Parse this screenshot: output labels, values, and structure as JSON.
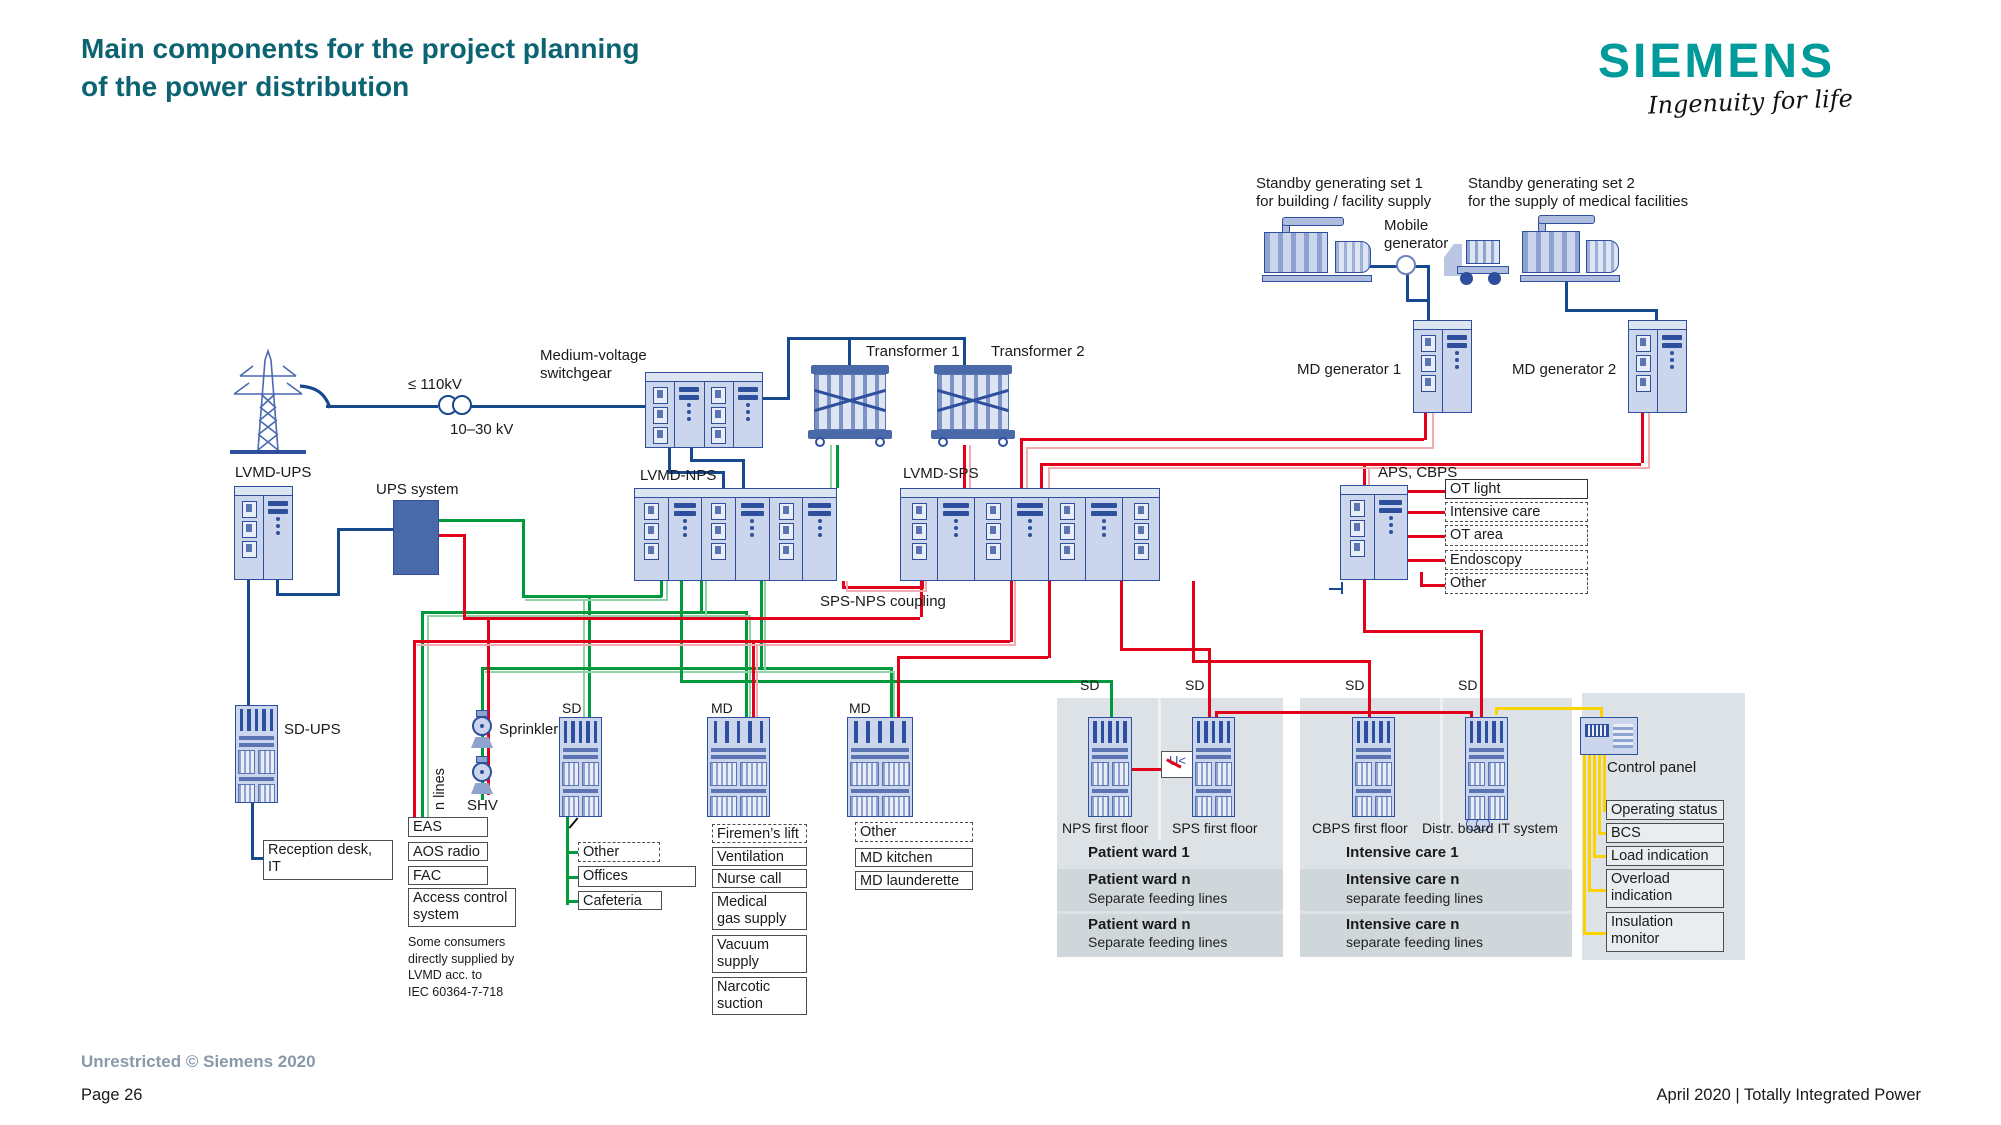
{
  "header": {
    "title": "Main components for the project planning\nof the power distribution",
    "brand": "SIEMENS",
    "tagline": "Ingenuity for life"
  },
  "footer": {
    "classification": "Unrestricted © Siemens 2020",
    "page": "Page 26",
    "edition": "April 2020 | Totally Integrated Power"
  },
  "colors": {
    "accent_teal": "#0c6472",
    "brand_teal": "#009a9a",
    "wire_blue": "#17498f",
    "wire_green": "#009a3d",
    "wire_red": "#e2001a",
    "wire_yellow": "#fcd200",
    "cabinet_fill": "#cbd5eb",
    "cabinet_border": "#2e4f9e",
    "panel_gray": "#dce2e6"
  },
  "grid": {
    "hv": "≤ 110kV",
    "mv": "10–30 kV",
    "switchgear": "Medium-voltage\nswitchgear",
    "transformer1": "Transformer 1",
    "transformer2": "Transformer 2"
  },
  "generators": {
    "standby1": "Standby generating set 1\nfor building / facility supply",
    "standby2": "Standby generating set 2\nfor the supply of medical facilities",
    "mobile": "Mobile\ngenerator",
    "md1": "MD generator 1",
    "md2": "MD generator 2"
  },
  "mains": {
    "lvmd_ups": "LVMD-UPS",
    "ups": "UPS system",
    "lvmd_nps": "LVMD-NPS",
    "lvmd_sps": "LVMD-SPS",
    "coupling": "SPS-NPS coupling",
    "aps": "APS, CBPS"
  },
  "aps_outputs": [
    {
      "label": "OT light"
    },
    {
      "label": "Intensive care rooms"
    },
    {
      "label": "OT area"
    },
    {
      "label": "Endoscopy"
    },
    {
      "label": "Other"
    }
  ],
  "left_branch": {
    "sd_ups": "SD-UPS",
    "reception": "Reception desk,\nIT",
    "n_lines": "n lines",
    "sprinkler": "Sprinkler",
    "shv": "SHV",
    "boxes": [
      {
        "label": "EAS"
      },
      {
        "label": "AOS radio"
      },
      {
        "label": "FAC"
      },
      {
        "label": "Access control\nsystem"
      }
    ],
    "note": "Some consumers\ndirectly supplied by\nLVMD acc. to\nIEC 60364-7-718"
  },
  "sub_boards": {
    "sd": "SD",
    "md1": "MD",
    "md2": "MD",
    "sd_outputs": [
      {
        "label": "Other"
      },
      {
        "label": "Offices"
      },
      {
        "label": "Cafeteria"
      }
    ],
    "md1_outputs": [
      {
        "label": "Firemen’s lift"
      },
      {
        "label": "Ventilation sys."
      },
      {
        "label": "Nurse call"
      },
      {
        "label": "Medical\ngas supply"
      },
      {
        "label": "Vacuum\nsupply"
      },
      {
        "label": "Narcotic\nsuction"
      }
    ],
    "md2_outputs": [
      {
        "label": "Other"
      },
      {
        "label": "MD kitchen"
      },
      {
        "label": "MD launderette"
      }
    ]
  },
  "floor_sd": [
    "SD",
    "SD",
    "SD",
    "SD"
  ],
  "ward_panel": {
    "board1": "NPS first floor",
    "board2": "SPS first floor",
    "relay": "U<",
    "rows": [
      {
        "title": "Patient ward 1",
        "sub": ""
      },
      {
        "title": "Patient ward n",
        "sub": "Separate feeding lines"
      },
      {
        "title": "Patient ward n",
        "sub": "Separate feeding lines"
      }
    ]
  },
  "icu_panel": {
    "board1": "CBPS first floor",
    "board2": "Distr. board IT system",
    "relay": "U<",
    "z": "Z",
    "rows": [
      {
        "title": "Intensive care 1",
        "sub": ""
      },
      {
        "title": "Intensive care n",
        "sub": "separate feeding lines"
      },
      {
        "title": "Intensive care n",
        "sub": "separate feeding lines"
      }
    ]
  },
  "control": {
    "label": "Control panel",
    "outputs": [
      {
        "label": "Operating status"
      },
      {
        "label": "BCS"
      },
      {
        "label": "Load indication"
      },
      {
        "label": "Overload\nindication"
      },
      {
        "label": "Insulation\nmonitor"
      }
    ]
  }
}
